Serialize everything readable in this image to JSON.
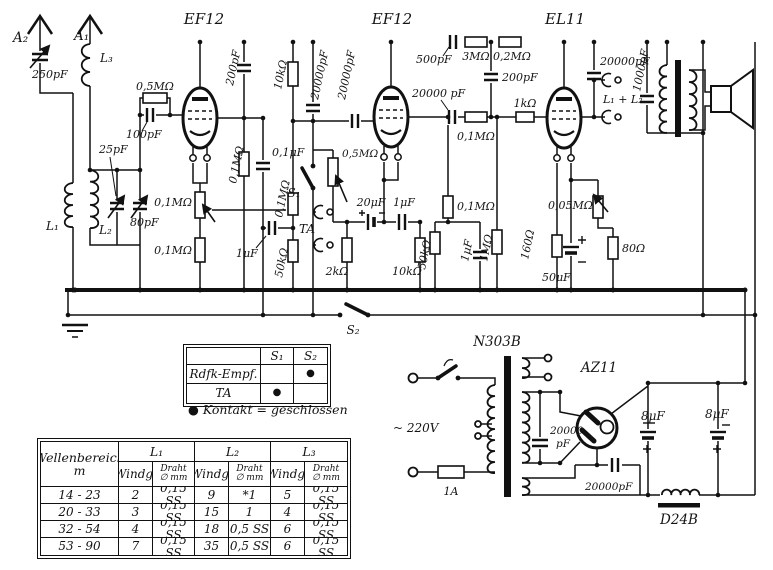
{
  "labels": {
    "a2": "A₂",
    "a1": "A₁",
    "l3": "L₃",
    "c250": "250pF",
    "l1": "L₁",
    "l2": "L₂",
    "c25": "25pF",
    "c80": "80pF",
    "v1": "EF12",
    "r05m": "0,5MΩ",
    "c100": "100pF",
    "c200a": "200pF",
    "r01m_a": "0,1MΩ",
    "c01uf": "0,1μF",
    "pot01m": "0,1MΩ",
    "r01m_b": "0,1MΩ",
    "c1uf_a": "1μF",
    "r10k_a": "10kΩ",
    "c20000_a": "20000pF",
    "c20000_b": "20000pF",
    "r01m_c": "0,1MΩ",
    "r50k_a": "50kΩ",
    "s1": "S₁",
    "pot05m": "0,5MΩ",
    "ta": "TA",
    "r2k": "2kΩ",
    "v2": "EF12",
    "c20uf": "20μF",
    "c1uf_b": "1μF",
    "r10k_b": "10kΩ",
    "r01m_d": "0,1MΩ",
    "r50k_b": "50kΩ",
    "c1uf_c": "1μF",
    "r1m": "1MΩ",
    "c500": "500pF",
    "r3m": "3MΩ",
    "r02m": "0,2MΩ",
    "c200b": "200pF",
    "c20000_c": "20000 pF",
    "r01m_e": "0,1MΩ",
    "r1k": "1kΩ",
    "v3": "EL11",
    "r160": "160Ω",
    "c50uf": "50μF",
    "pot005m": "0,05MΩ",
    "r80": "80Ω",
    "c20000_d": "20000pF",
    "l1l2": "L₁ + L₂",
    "c1000": "1000pF",
    "s2": "S₂",
    "n303b": "N303B",
    "v220": "~ 220V",
    "fuse": "1A",
    "az11": "AZ11",
    "c20000_e1": "20000",
    "c20000_e2": "pF",
    "c20000_f": "20000pF",
    "c8a": "8μF",
    "c8b": "8μF",
    "d24b": "D24B"
  },
  "switch_table": {
    "col_s1": "S₁",
    "col_s2": "S₂",
    "row1": "Rdfk-Empf.",
    "row2": "TA",
    "dot": "●",
    "caption": "● Kontakt = geschlossen"
  },
  "coil_table": {
    "header": "Wellenbereich",
    "header_unit": "m",
    "l1": "L₁",
    "l2": "L₂",
    "l3": "L₃",
    "windg": "Windg.",
    "draht1": "Draht",
    "draht2": "∅ mm",
    "rows": [
      {
        "range": "14 - 23",
        "c": [
          "2",
          "0,15 SS",
          "9",
          "*1",
          "5",
          "0,15 SS"
        ]
      },
      {
        "range": "20 - 33",
        "c": [
          "3",
          "0,15 SS",
          "15",
          "1",
          "4",
          "0,15 SS"
        ]
      },
      {
        "range": "32 - 54",
        "c": [
          "4",
          "0,15 SS",
          "18",
          "0,5 SS",
          "6",
          "0,15 SS"
        ]
      },
      {
        "range": "53 - 90",
        "c": [
          "7",
          "0,15 SS",
          "35",
          "0,5 SS",
          "6",
          "0,15 SS"
        ]
      }
    ]
  }
}
